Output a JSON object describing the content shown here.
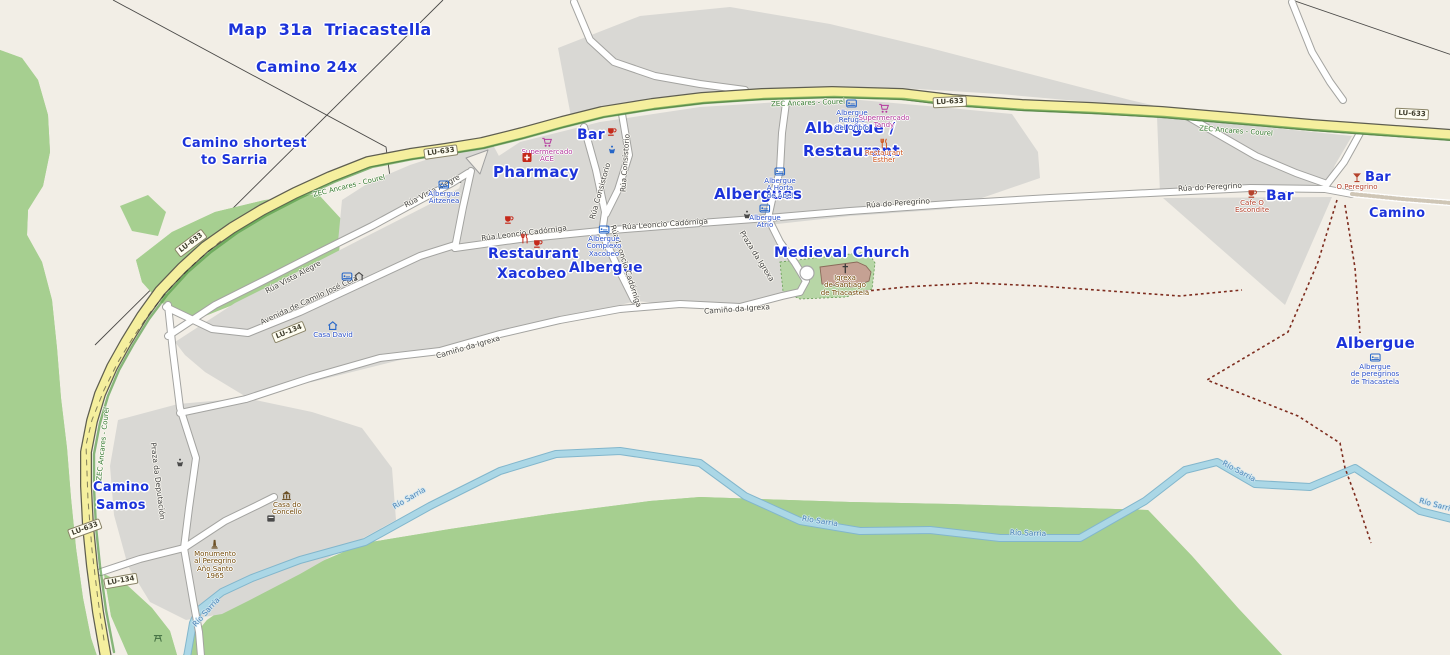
{
  "meta": {
    "page_title": "Map 31a Triacastella"
  },
  "colors": {
    "annotation_blue": "#1c33da",
    "poi_blue": "#2b50c8",
    "supermarket_magenta": "#b5399e",
    "restaurant_orange": "#d2571f",
    "bar_red": "#c5291a",
    "dark_red": "#b5422c",
    "amenity_brown": "#734a08",
    "water_blue": "#4f86b8",
    "zec_green": "#337a33",
    "street_label_gray": "#454545",
    "road_yellow": "#f5ef9e",
    "forest_green": "#a6cf90",
    "residential_gray": "#d9d8d4",
    "river_blue": "#a9d6e6"
  },
  "annotations": [
    {
      "id": "map-title",
      "text": "Map  31a  Triacastella",
      "x": 228,
      "y": 20,
      "size": 16
    },
    {
      "id": "camino-24x",
      "text": "Camino 24x",
      "x": 256,
      "y": 58,
      "size": 15
    },
    {
      "id": "camino-shortest-1",
      "text": "Camino shortest",
      "x": 182,
      "y": 136,
      "size": 13
    },
    {
      "id": "camino-shortest-2",
      "text": "to Sarria",
      "x": 201,
      "y": 153,
      "size": 13
    },
    {
      "id": "pharmacy",
      "text": "Pharmacy",
      "x": 493,
      "y": 163,
      "size": 15
    },
    {
      "id": "bar-center",
      "text": "Bar",
      "x": 577,
      "y": 127,
      "size": 14
    },
    {
      "id": "albergue-restaurant-1",
      "text": "Albergue /",
      "x": 805,
      "y": 119,
      "size": 15
    },
    {
      "id": "albergue-restaurant-2",
      "text": "Restaurant",
      "x": 803,
      "y": 142,
      "size": 15
    },
    {
      "id": "albergues",
      "text": "Albergues",
      "x": 714,
      "y": 185,
      "size": 15
    },
    {
      "id": "medieval-church",
      "text": "Medieval Church",
      "x": 774,
      "y": 245,
      "size": 14
    },
    {
      "id": "restaurant-xacobeo-1",
      "text": "Restaurant",
      "x": 488,
      "y": 246,
      "size": 14
    },
    {
      "id": "restaurant-xacobeo-2",
      "text": "Xacobeo",
      "x": 497,
      "y": 266,
      "size": 14
    },
    {
      "id": "albergue-mid",
      "text": "Albergue",
      "x": 569,
      "y": 260,
      "size": 14
    },
    {
      "id": "bar-east-1",
      "text": "Bar",
      "x": 1266,
      "y": 188,
      "size": 14
    },
    {
      "id": "bar-east-2",
      "text": "Bar",
      "x": 1365,
      "y": 170,
      "size": 13
    },
    {
      "id": "camino-east",
      "text": "Camino",
      "x": 1369,
      "y": 206,
      "size": 13
    },
    {
      "id": "albergue-southeast",
      "text": "Albergue",
      "x": 1336,
      "y": 334,
      "size": 15
    },
    {
      "id": "camino-samos-1",
      "text": "Camino",
      "x": 93,
      "y": 480,
      "size": 13
    },
    {
      "id": "camino-samos-2",
      "text": "Samos",
      "x": 96,
      "y": 498,
      "size": 13
    }
  ],
  "road_shields": [
    {
      "text": "LU-633",
      "x": 441,
      "y": 152,
      "rot": -8
    },
    {
      "text": "LU-633",
      "x": 950,
      "y": 102,
      "rot": -3
    },
    {
      "text": "LU-633",
      "x": 1412,
      "y": 114,
      "rot": 3
    },
    {
      "text": "LU-633",
      "x": 191,
      "y": 243,
      "rot": -37
    },
    {
      "text": "LU-633",
      "x": 85,
      "y": 529,
      "rot": -20
    },
    {
      "text": "LU-134",
      "x": 121,
      "y": 581,
      "rot": -10
    },
    {
      "text": "LU-134",
      "x": 289,
      "y": 332,
      "rot": -22
    }
  ],
  "street_labels": [
    {
      "text": "Rúa Vista Alegre",
      "x": 432,
      "y": 191,
      "rot": -28
    },
    {
      "text": "Rúa Vista Alegre",
      "x": 293,
      "y": 277,
      "rot": -28
    },
    {
      "text": "Avenida de Camilo José Cela",
      "x": 309,
      "y": 300,
      "rot": -25
    },
    {
      "text": "Rúa Leoncio Cadórniga",
      "x": 524,
      "y": 233,
      "rot": -7
    },
    {
      "text": "Rúa Leoncio Cadórniga",
      "x": 665,
      "y": 224,
      "rot": -4
    },
    {
      "text": "Rúa Leoncio Cadórniga",
      "x": 626,
      "y": 266,
      "rot": 72
    },
    {
      "text": "Rúa Consistorio",
      "x": 600,
      "y": 191,
      "rot": -74
    },
    {
      "text": "Rúa Consistorio",
      "x": 625,
      "y": 163,
      "rot": -86
    },
    {
      "text": "Rúa do Peregrino",
      "x": 898,
      "y": 203,
      "rot": -4
    },
    {
      "text": "Rúa do Peregrino",
      "x": 1210,
      "y": 187,
      "rot": -3
    },
    {
      "text": "Camiño da Igrexa",
      "x": 468,
      "y": 347,
      "rot": -16
    },
    {
      "text": "Camiño da Igrexa",
      "x": 737,
      "y": 309,
      "rot": -4
    },
    {
      "text": "Praza da Igrexa",
      "x": 757,
      "y": 256,
      "rot": 58
    },
    {
      "text": "Praza da Deputación",
      "x": 158,
      "y": 481,
      "rot": 83
    }
  ],
  "boundary_labels": [
    {
      "text": "ZEC Ancares - Courel",
      "x": 349,
      "y": 186,
      "rot": -14
    },
    {
      "text": "ZEC Ancares - Courel",
      "x": 808,
      "y": 103,
      "rot": -2
    },
    {
      "text": "ZEC Ancares - Courel",
      "x": 1236,
      "y": 131,
      "rot": 4
    },
    {
      "text": "ZEC Ancares - Courel",
      "x": 103,
      "y": 444,
      "rot": -84
    }
  ],
  "water_labels": [
    {
      "text": "Río Sarria",
      "x": 409,
      "y": 498,
      "rot": -30
    },
    {
      "text": "Río Sarria",
      "x": 820,
      "y": 521,
      "rot": 9
    },
    {
      "text": "Río Sarria",
      "x": 1028,
      "y": 533,
      "rot": 2
    },
    {
      "text": "Río Sarria",
      "x": 1239,
      "y": 471,
      "rot": 28
    },
    {
      "text": "Río Sarria",
      "x": 1437,
      "y": 505,
      "rot": 15
    },
    {
      "text": "Río Sarria",
      "x": 206,
      "y": 612,
      "rot": -48
    }
  ],
  "pois": [
    {
      "name": "albergue-aitzenea",
      "icon": "bed",
      "x": 444,
      "y": 184,
      "lines": [
        "Albergue",
        "Aitzenea"
      ],
      "color": "blue"
    },
    {
      "name": "supermercado-ace",
      "icon": "cart",
      "x": 547,
      "y": 142,
      "lines": [
        "Supermercado",
        "ACE"
      ],
      "color": "magenta"
    },
    {
      "name": "pharmacy",
      "icon": "pharmacy",
      "x": 527,
      "y": 157,
      "lines": [],
      "color": "red"
    },
    {
      "name": "bar-top",
      "icon": "cup",
      "x": 612,
      "y": 131,
      "lines": [],
      "color": "red"
    },
    {
      "name": "drinking-water",
      "icon": "fountain",
      "x": 612,
      "y": 149,
      "lines": [],
      "color": "blue"
    },
    {
      "name": "albergue-refugio-oribio",
      "icon": "bed",
      "x": 852,
      "y": 103,
      "lines": [
        "Albergue",
        "Refugio",
        "del Oribio"
      ],
      "color": "blue"
    },
    {
      "name": "supermercado-tandy",
      "icon": "cart",
      "x": 884,
      "y": 108,
      "lines": [
        "Supermercado",
        "Tandy"
      ],
      "color": "magenta"
    },
    {
      "name": "restaurant-esther",
      "icon": "fork",
      "x": 884,
      "y": 143,
      "lines": [
        "Restaurant",
        "Esther"
      ],
      "color": "orange"
    },
    {
      "name": "albergue-a-horta-de-abel",
      "icon": "bed",
      "x": 780,
      "y": 171,
      "lines": [
        "Albergue",
        "A Horta",
        "de Abel"
      ],
      "color": "blue"
    },
    {
      "name": "albergue-atrio",
      "icon": "bed",
      "x": 765,
      "y": 208,
      "lines": [
        "Albergue",
        "Atrio"
      ],
      "color": "blue"
    },
    {
      "name": "fountain-atrio",
      "icon": "fountain",
      "x": 747,
      "y": 214,
      "lines": [],
      "color": "gray"
    },
    {
      "name": "bar-leoncio",
      "icon": "cup",
      "x": 509,
      "y": 219,
      "lines": [],
      "color": "red"
    },
    {
      "name": "restaurant-xacobeo",
      "icon": "fork",
      "x": 525,
      "y": 238,
      "lines": [],
      "color": "red"
    },
    {
      "name": "bar-xacobeo",
      "icon": "cup",
      "x": 538,
      "y": 243,
      "lines": [],
      "color": "red"
    },
    {
      "name": "albergue-complexo-xacobeo",
      "icon": "bed",
      "x": 604,
      "y": 229,
      "lines": [
        "Albergue",
        "Complexo",
        "Xacobeo"
      ],
      "color": "blue"
    },
    {
      "name": "casa-david",
      "icon": "house",
      "x": 333,
      "y": 325,
      "lines": [
        "Casa David"
      ],
      "color": "blue"
    },
    {
      "name": "hotel-bed",
      "icon": "bed",
      "x": 347,
      "y": 276,
      "lines": [],
      "color": "blue"
    },
    {
      "name": "hotel-shelter",
      "icon": "shelter",
      "x": 359,
      "y": 276,
      "lines": [],
      "color": "gray"
    },
    {
      "name": "cafe-o-escondite",
      "icon": "cup",
      "x": 1252,
      "y": 193,
      "lines": [
        "Cafe O",
        "Escondite"
      ],
      "color": "darkred"
    },
    {
      "name": "o-peregrino",
      "icon": "martini",
      "x": 1357,
      "y": 177,
      "lines": [
        "O Peregrino"
      ],
      "color": "darkred"
    },
    {
      "name": "albergue-peregrinos",
      "icon": "bed",
      "x": 1375,
      "y": 357,
      "lines": [
        "Albergue",
        "de peregrinos",
        "de Triacastela"
      ],
      "color": "blue"
    },
    {
      "name": "igrexa-santiago",
      "icon": "cross",
      "x": 845,
      "y": 268,
      "lines": [
        "Igrexa",
        "de Santiago",
        "de Triacastela"
      ],
      "color": "brown"
    },
    {
      "name": "casa-do-concello",
      "icon": "townhall",
      "x": 287,
      "y": 495,
      "lines": [
        "Casa do",
        "Concello"
      ],
      "color": "brown"
    },
    {
      "name": "postbox",
      "icon": "postbox",
      "x": 271,
      "y": 518,
      "lines": [],
      "color": "gray"
    },
    {
      "name": "monumento-peregrino",
      "icon": "monument",
      "x": 215,
      "y": 544,
      "lines": [
        "Monumento",
        "al Peregrino",
        "Año Santo",
        "1965"
      ],
      "color": "brown"
    },
    {
      "name": "fountain-deputacion",
      "icon": "fountain",
      "x": 180,
      "y": 462,
      "lines": [],
      "color": "gray"
    },
    {
      "name": "picnic-site",
      "icon": "picnic",
      "x": 158,
      "y": 637,
      "lines": [],
      "color": "green"
    }
  ]
}
